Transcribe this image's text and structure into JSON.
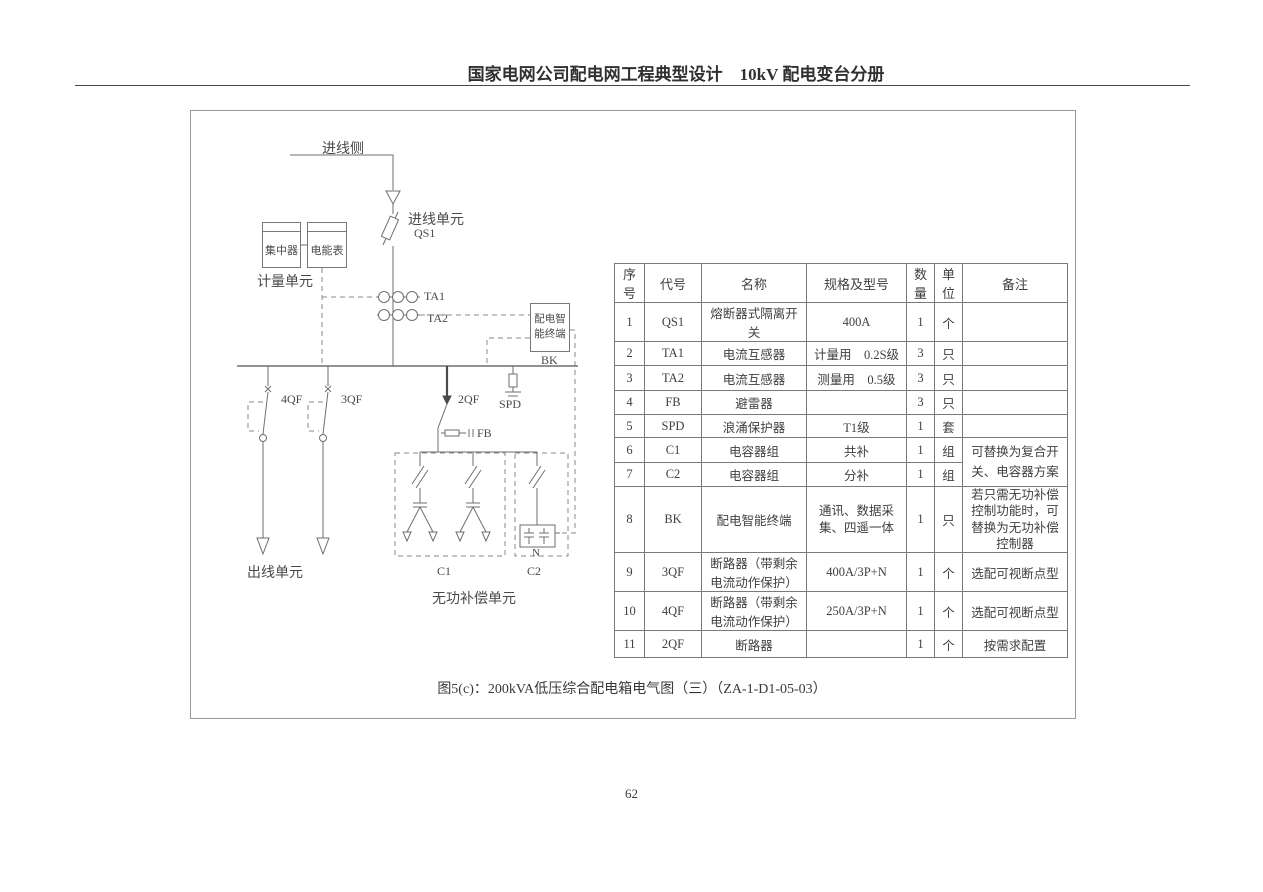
{
  "header": {
    "title": "国家电网公司配电网工程典型设计　10kV 配电变台分册"
  },
  "diagram": {
    "labels": {
      "incoming_side": "进线侧",
      "incoming_unit": "进线单元",
      "qs1": "QS1",
      "concentrator": "集中器",
      "energy_meter": "电能表",
      "metering_unit": "计量单元",
      "ta1": "TA1",
      "ta2": "TA2",
      "smart_terminal": "配电智能终端",
      "bk": "BK",
      "qf4": "4QF",
      "qf3": "3QF",
      "qf2": "2QF",
      "spd": "SPD",
      "fb": "FB",
      "outgoing_unit": "出线单元",
      "c1": "C1",
      "c2": "C2",
      "neutral": "N",
      "reactive_comp_unit": "无功补偿单元"
    }
  },
  "table": {
    "headers": [
      "序号",
      "代号",
      "名称",
      "规格及型号",
      "数量",
      "单位",
      "备注"
    ],
    "rows": [
      {
        "seq": "1",
        "code": "QS1",
        "name": "熔断器式隔离开关",
        "spec": "400A",
        "qty": "1",
        "unit": "个",
        "remark": ""
      },
      {
        "seq": "2",
        "code": "TA1",
        "name": "电流互感器",
        "spec": "计量用　0.2S级",
        "qty": "3",
        "unit": "只",
        "remark": ""
      },
      {
        "seq": "3",
        "code": "TA2",
        "name": "电流互感器",
        "spec": "测量用　0.5级",
        "qty": "3",
        "unit": "只",
        "remark": ""
      },
      {
        "seq": "4",
        "code": "FB",
        "name": "避雷器",
        "spec": "",
        "qty": "3",
        "unit": "只",
        "remark": ""
      },
      {
        "seq": "5",
        "code": "SPD",
        "name": "浪涌保护器",
        "spec": "T1级",
        "qty": "1",
        "unit": "套",
        "remark": ""
      },
      {
        "seq": "6",
        "code": "C1",
        "name": "电容器组",
        "spec": "共补",
        "qty": "1",
        "unit": "组",
        "remark": "可替换为复合开关、电容器方案"
      },
      {
        "seq": "7",
        "code": "C2",
        "name": "电容器组",
        "spec": "分补",
        "qty": "1",
        "unit": "组",
        "remark": ""
      },
      {
        "seq": "8",
        "code": "BK",
        "name": "配电智能终端",
        "spec": "通讯、数据采集、四遥一体",
        "qty": "1",
        "unit": "只",
        "remark": "若只需无功补偿控制功能时，可替换为无功补偿控制器"
      },
      {
        "seq": "9",
        "code": "3QF",
        "name": "断路器（带剩余电流动作保护）",
        "spec": "400A/3P+N",
        "qty": "1",
        "unit": "个",
        "remark": "选配可视断点型"
      },
      {
        "seq": "10",
        "code": "4QF",
        "name": "断路器（带剩余电流动作保护）",
        "spec": "250A/3P+N",
        "qty": "1",
        "unit": "个",
        "remark": "选配可视断点型"
      },
      {
        "seq": "11",
        "code": "2QF",
        "name": "断路器",
        "spec": "",
        "qty": "1",
        "unit": "个",
        "remark": "按需求配置"
      }
    ]
  },
  "caption": "图5(c)：200kVA低压综合配电箱电气图（三）（ZA-1-D1-05-03）",
  "page_number": "62"
}
